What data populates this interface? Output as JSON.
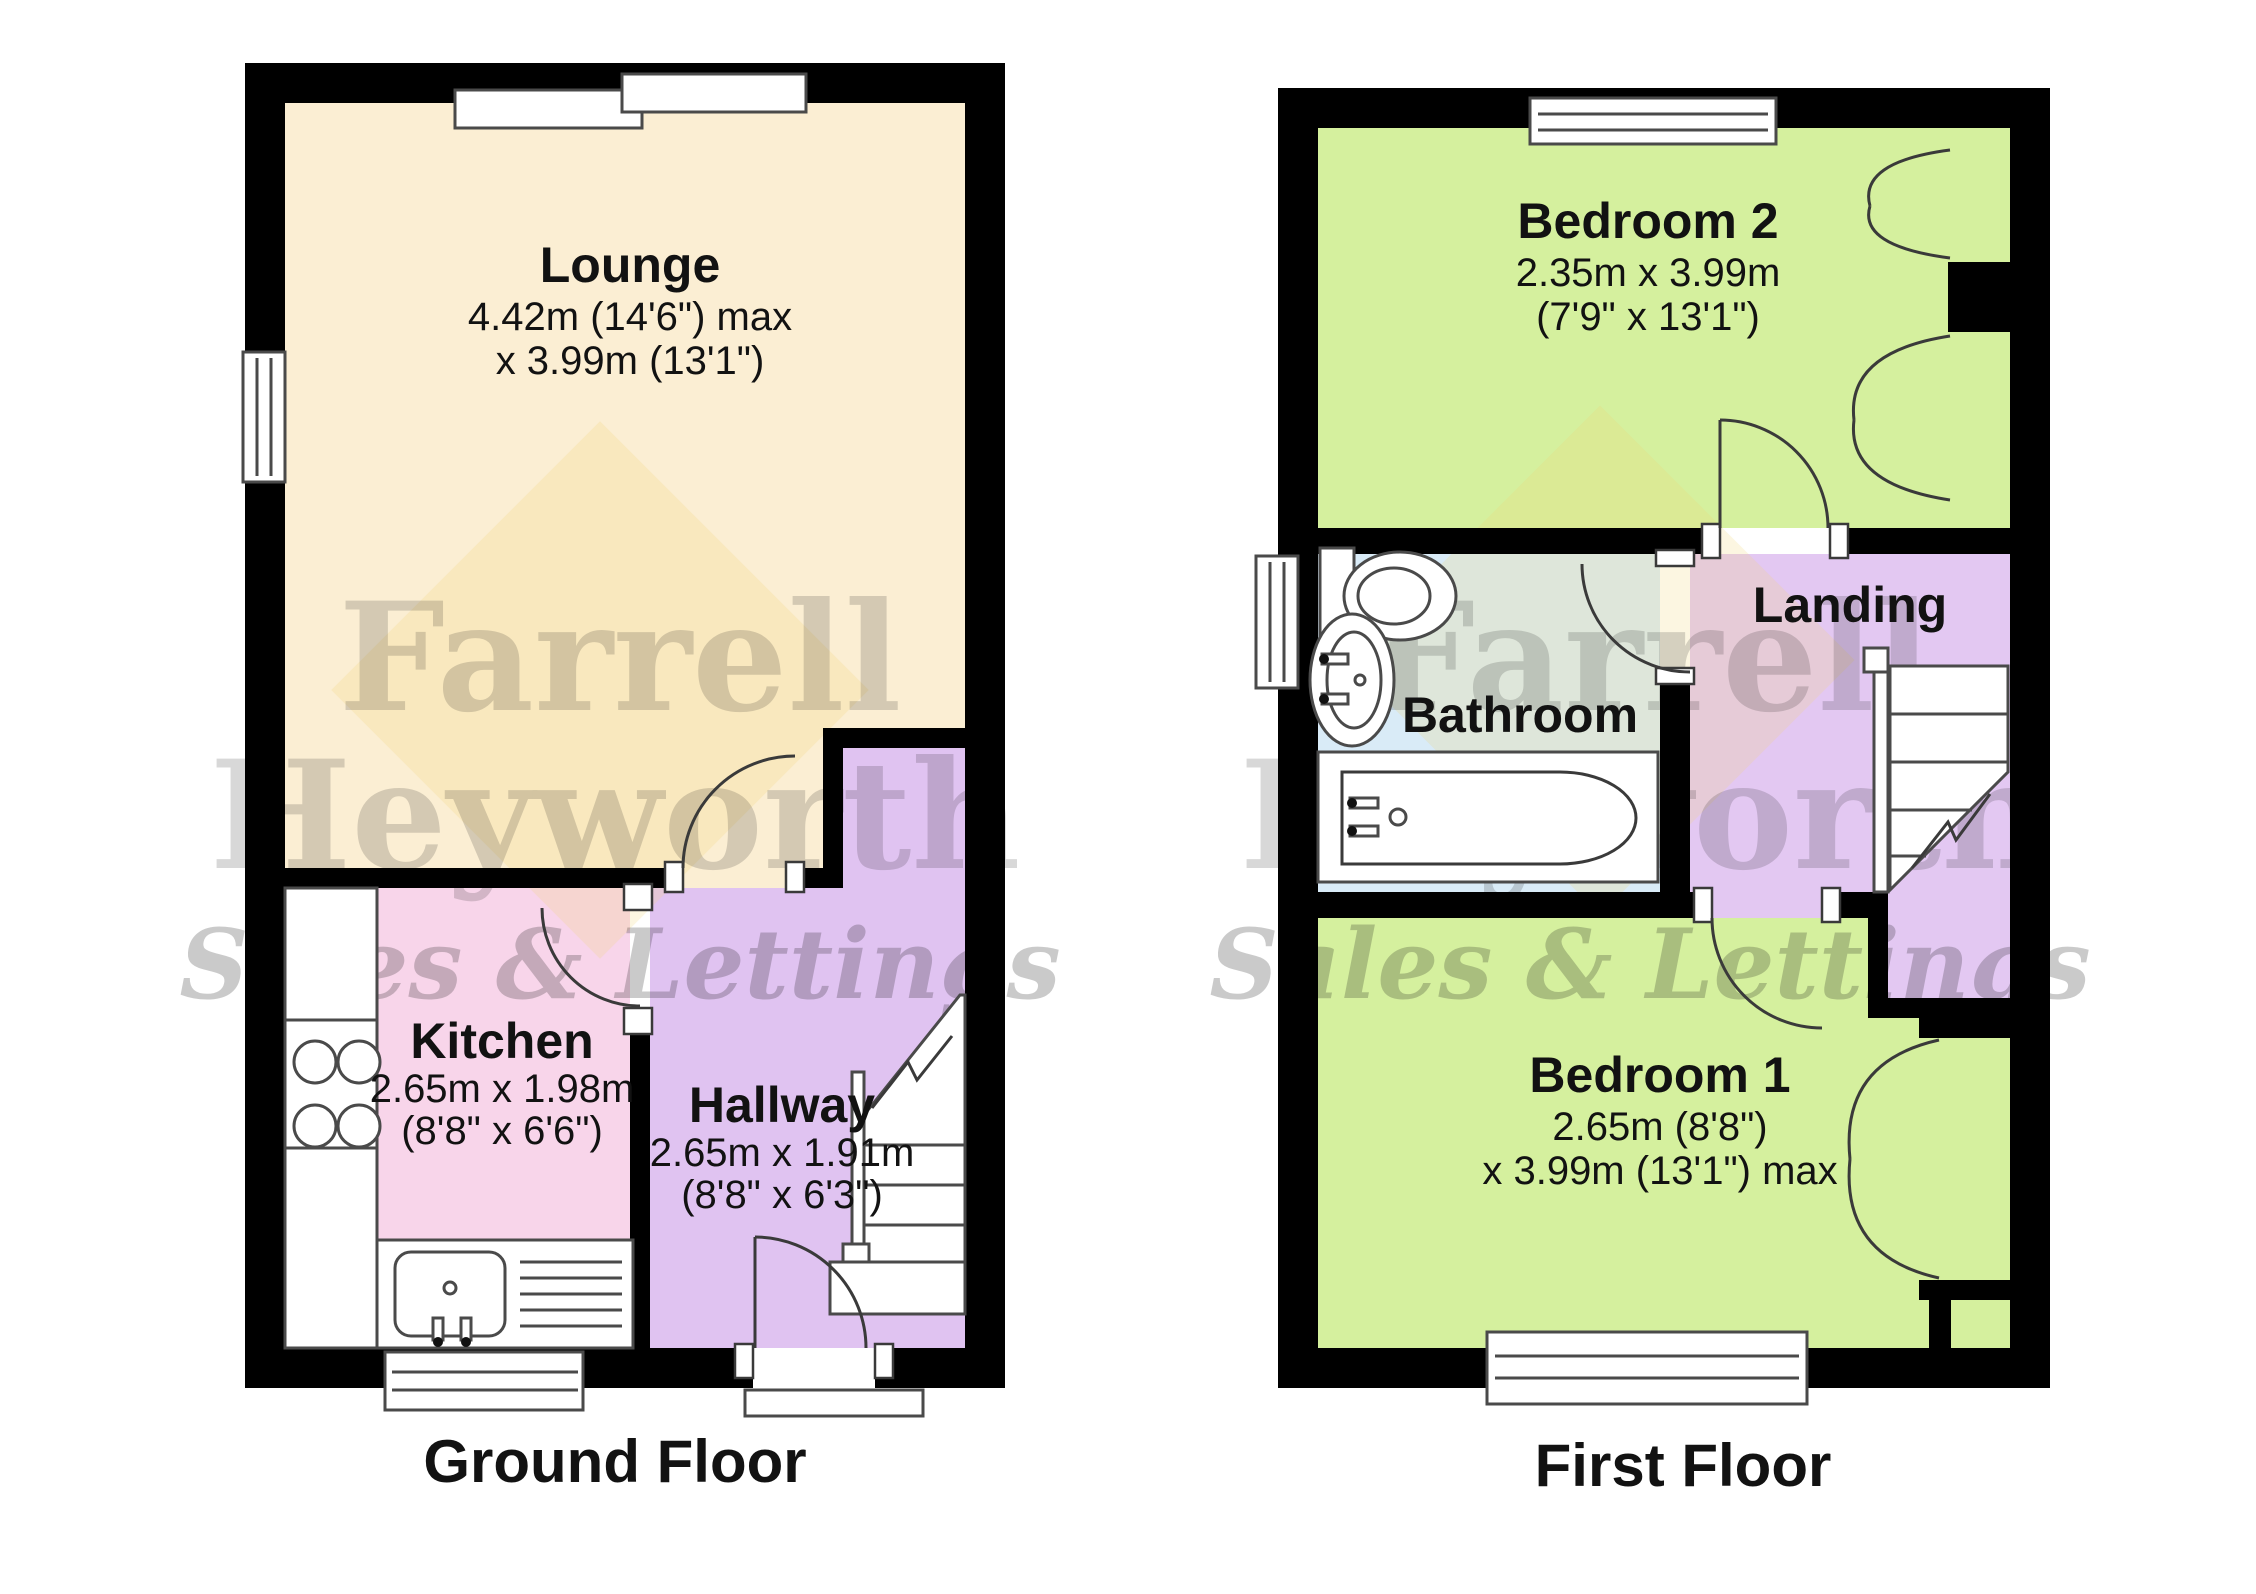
{
  "watermark": {
    "line1": "Farrell",
    "line2": "Heyworth",
    "tagline": "Sales & Lettings"
  },
  "colors": {
    "wall": "#000000",
    "lounge": "#fbeed3",
    "kitchen": "#f8d5ea",
    "hallway": "#e0c3f1",
    "bedroom": "#d5f09e",
    "bathroom": "#d9ebf7",
    "landing": "#e3c8f2",
    "watermark_text": "#8a8274",
    "watermark_tagline": "#e0607e",
    "diamond": "#f3d878"
  },
  "ground_floor": {
    "title": "Ground Floor",
    "lounge": {
      "name": "Lounge",
      "dim1": "4.42m (14'6\") max",
      "dim2": "x 3.99m (13'1\")"
    },
    "kitchen": {
      "name": "Kitchen",
      "dim1": "2.65m x 1.98m",
      "dim2": "(8'8\" x 6'6\")"
    },
    "hallway": {
      "name": "Hallway",
      "dim1": "2.65m x 1.91m",
      "dim2": "(8'8\" x 6'3\")"
    }
  },
  "first_floor": {
    "title": "First Floor",
    "bedroom2": {
      "name": "Bedroom 2",
      "dim1": "2.35m x 3.99m",
      "dim2": "(7'9\" x 13'1\")"
    },
    "bathroom": {
      "name": "Bathroom"
    },
    "landing": {
      "name": "Landing"
    },
    "bedroom1": {
      "name": "Bedroom 1",
      "dim1": "2.65m (8'8\")",
      "dim2": "x 3.99m (13'1\") max"
    }
  }
}
